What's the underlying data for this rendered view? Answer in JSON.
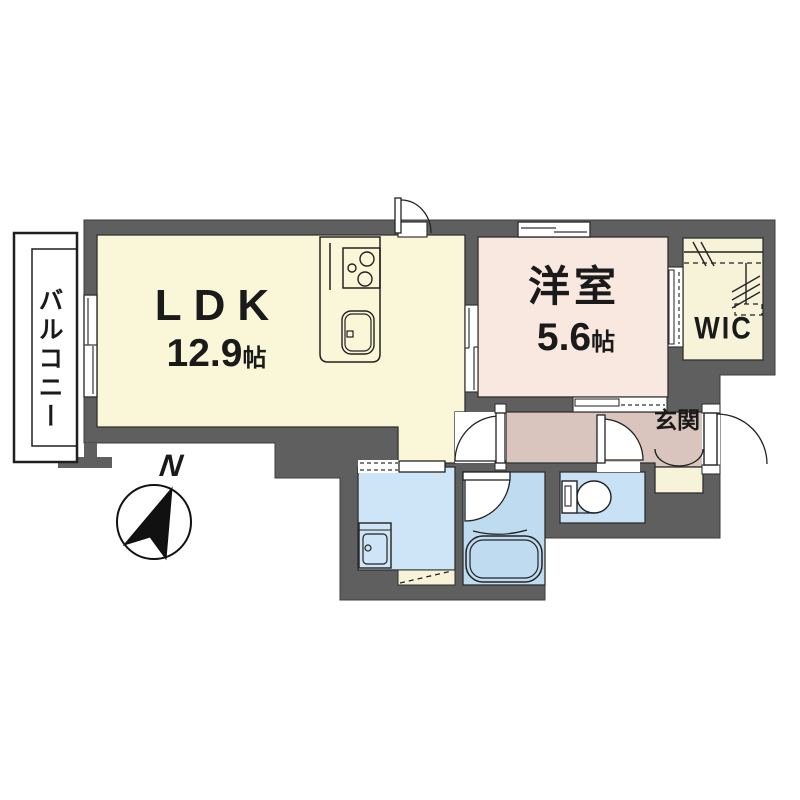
{
  "colors": {
    "wall": "#5f5f5f",
    "outline": "#1f1f1f",
    "ldk": "#f9f7d8",
    "bedroom": "#f8e8e0",
    "hall": "#d9c5be",
    "cream": "#f6f3d8",
    "washroom": "#cde5f6",
    "bath": "#bfdbf0",
    "toilet": "#c8e1f4",
    "paper": "#ffffff"
  },
  "rooms": {
    "ldk": {
      "name": "LDK",
      "area_value": "12.9",
      "area_unit": "帖"
    },
    "bedroom": {
      "name": "洋室",
      "area_value": "5.6",
      "area_unit": "帖"
    },
    "wic": {
      "label": "WIC"
    },
    "entrance": {
      "label": "玄関"
    },
    "balcony": {
      "label": "バルコニー"
    }
  },
  "compass": {
    "north_label": "N"
  }
}
